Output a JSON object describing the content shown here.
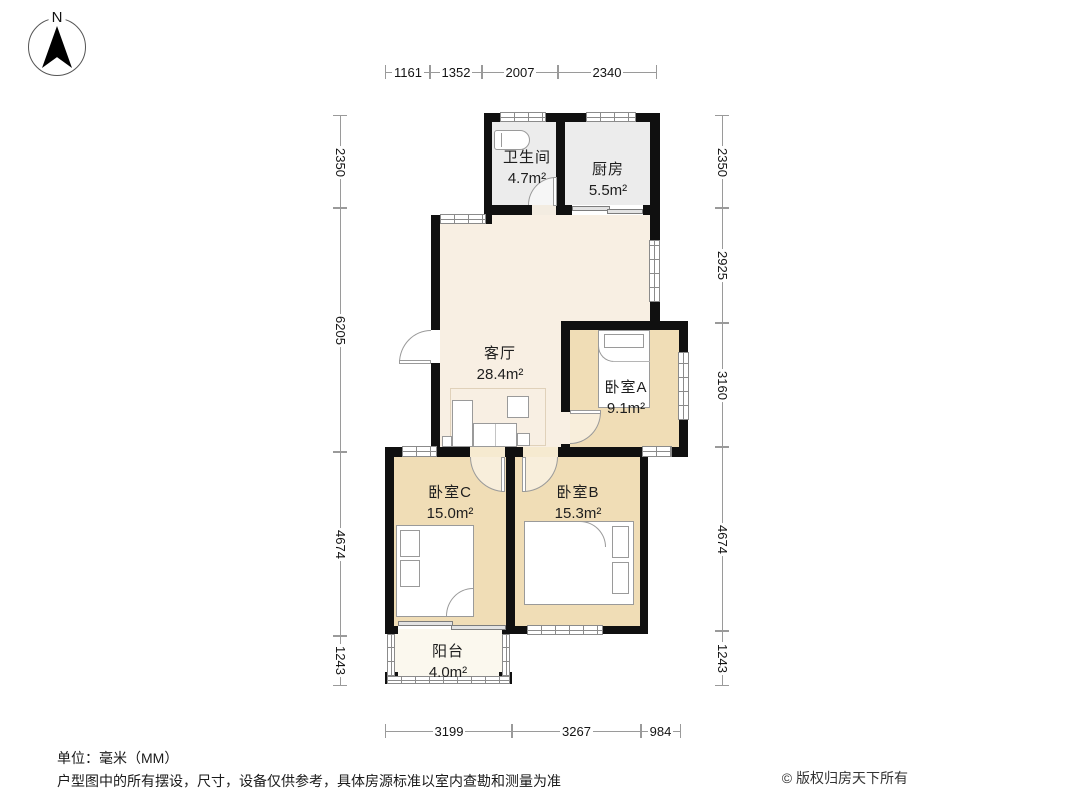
{
  "compass": {
    "label": "N"
  },
  "rooms": [
    {
      "id": "bathroom",
      "name": "卫生间",
      "area": "4.7m²"
    },
    {
      "id": "kitchen",
      "name": "厨房",
      "area": "5.5m²"
    },
    {
      "id": "living",
      "name": "客厅",
      "area": "28.4m²"
    },
    {
      "id": "bedroomA",
      "name": "卧室A",
      "area": "9.1m²"
    },
    {
      "id": "bedroomB",
      "name": "卧室B",
      "area": "15.3m²"
    },
    {
      "id": "bedroomC",
      "name": "卧室C",
      "area": "15.0m²"
    },
    {
      "id": "balcony",
      "name": "阳台",
      "area": "4.0m²"
    }
  ],
  "dimensions": {
    "top": [
      "1161",
      "1352",
      "2007",
      "2340"
    ],
    "bottom": [
      "3199",
      "3267",
      "984"
    ],
    "left": [
      "2350",
      "6205",
      "4674",
      "1243"
    ],
    "right": [
      "2350",
      "2925",
      "3160",
      "4674",
      "1243"
    ]
  },
  "footer": {
    "unit": "单位：毫米（MM）",
    "disclaimer": "户型图中的所有摆设，尺寸，设备仅供参考，具体房源标准以室内查勘和测量为准",
    "copyright": "© 版权归房天下所有"
  },
  "colors": {
    "wall": "#101010",
    "floor_living": "#f8efe3",
    "floor_bedroom": "#f0ddb6",
    "floor_service": "#ececec",
    "floor_balcony": "#fbf8ee",
    "dim_line": "#9a9a9a"
  }
}
